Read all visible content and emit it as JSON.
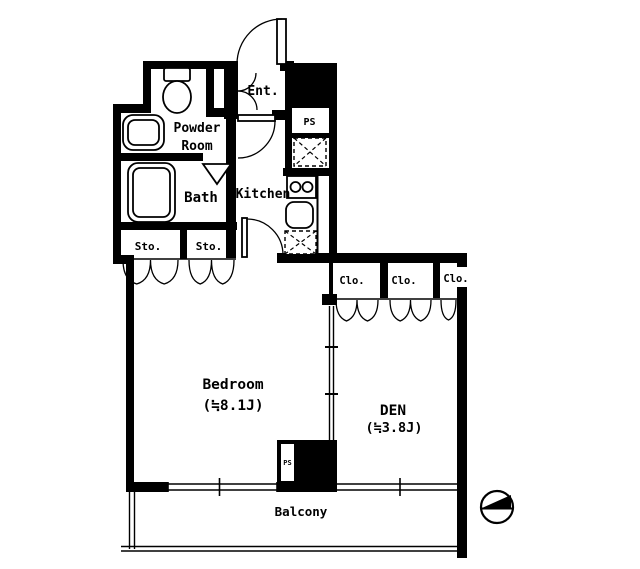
{
  "colors": {
    "wall": "#000000",
    "background": "#ffffff"
  },
  "rooms": {
    "entrance": {
      "label": "Ent."
    },
    "shoe_box": {
      "label": "ShoeBox"
    },
    "powder_room": {
      "label_line1": "Powder",
      "label_line2": "Room"
    },
    "bath": {
      "label": "Bath"
    },
    "kitchen": {
      "label": "Kitchen"
    },
    "storage_1": {
      "label": "Sto."
    },
    "storage_2": {
      "label": "Sto."
    },
    "closet_1": {
      "label": "Clo."
    },
    "closet_2": {
      "label": "Clo."
    },
    "closet_3": {
      "label": "Clo."
    },
    "bedroom": {
      "label": "Bedroom",
      "size": "(≒8.1J)"
    },
    "den": {
      "label": "DEN",
      "size": "(≒3.8J)"
    },
    "balcony": {
      "label": "Balcony"
    }
  },
  "pipe_space_top": {
    "label": "PS"
  },
  "pipe_space_bottom": {
    "label": "PS"
  }
}
